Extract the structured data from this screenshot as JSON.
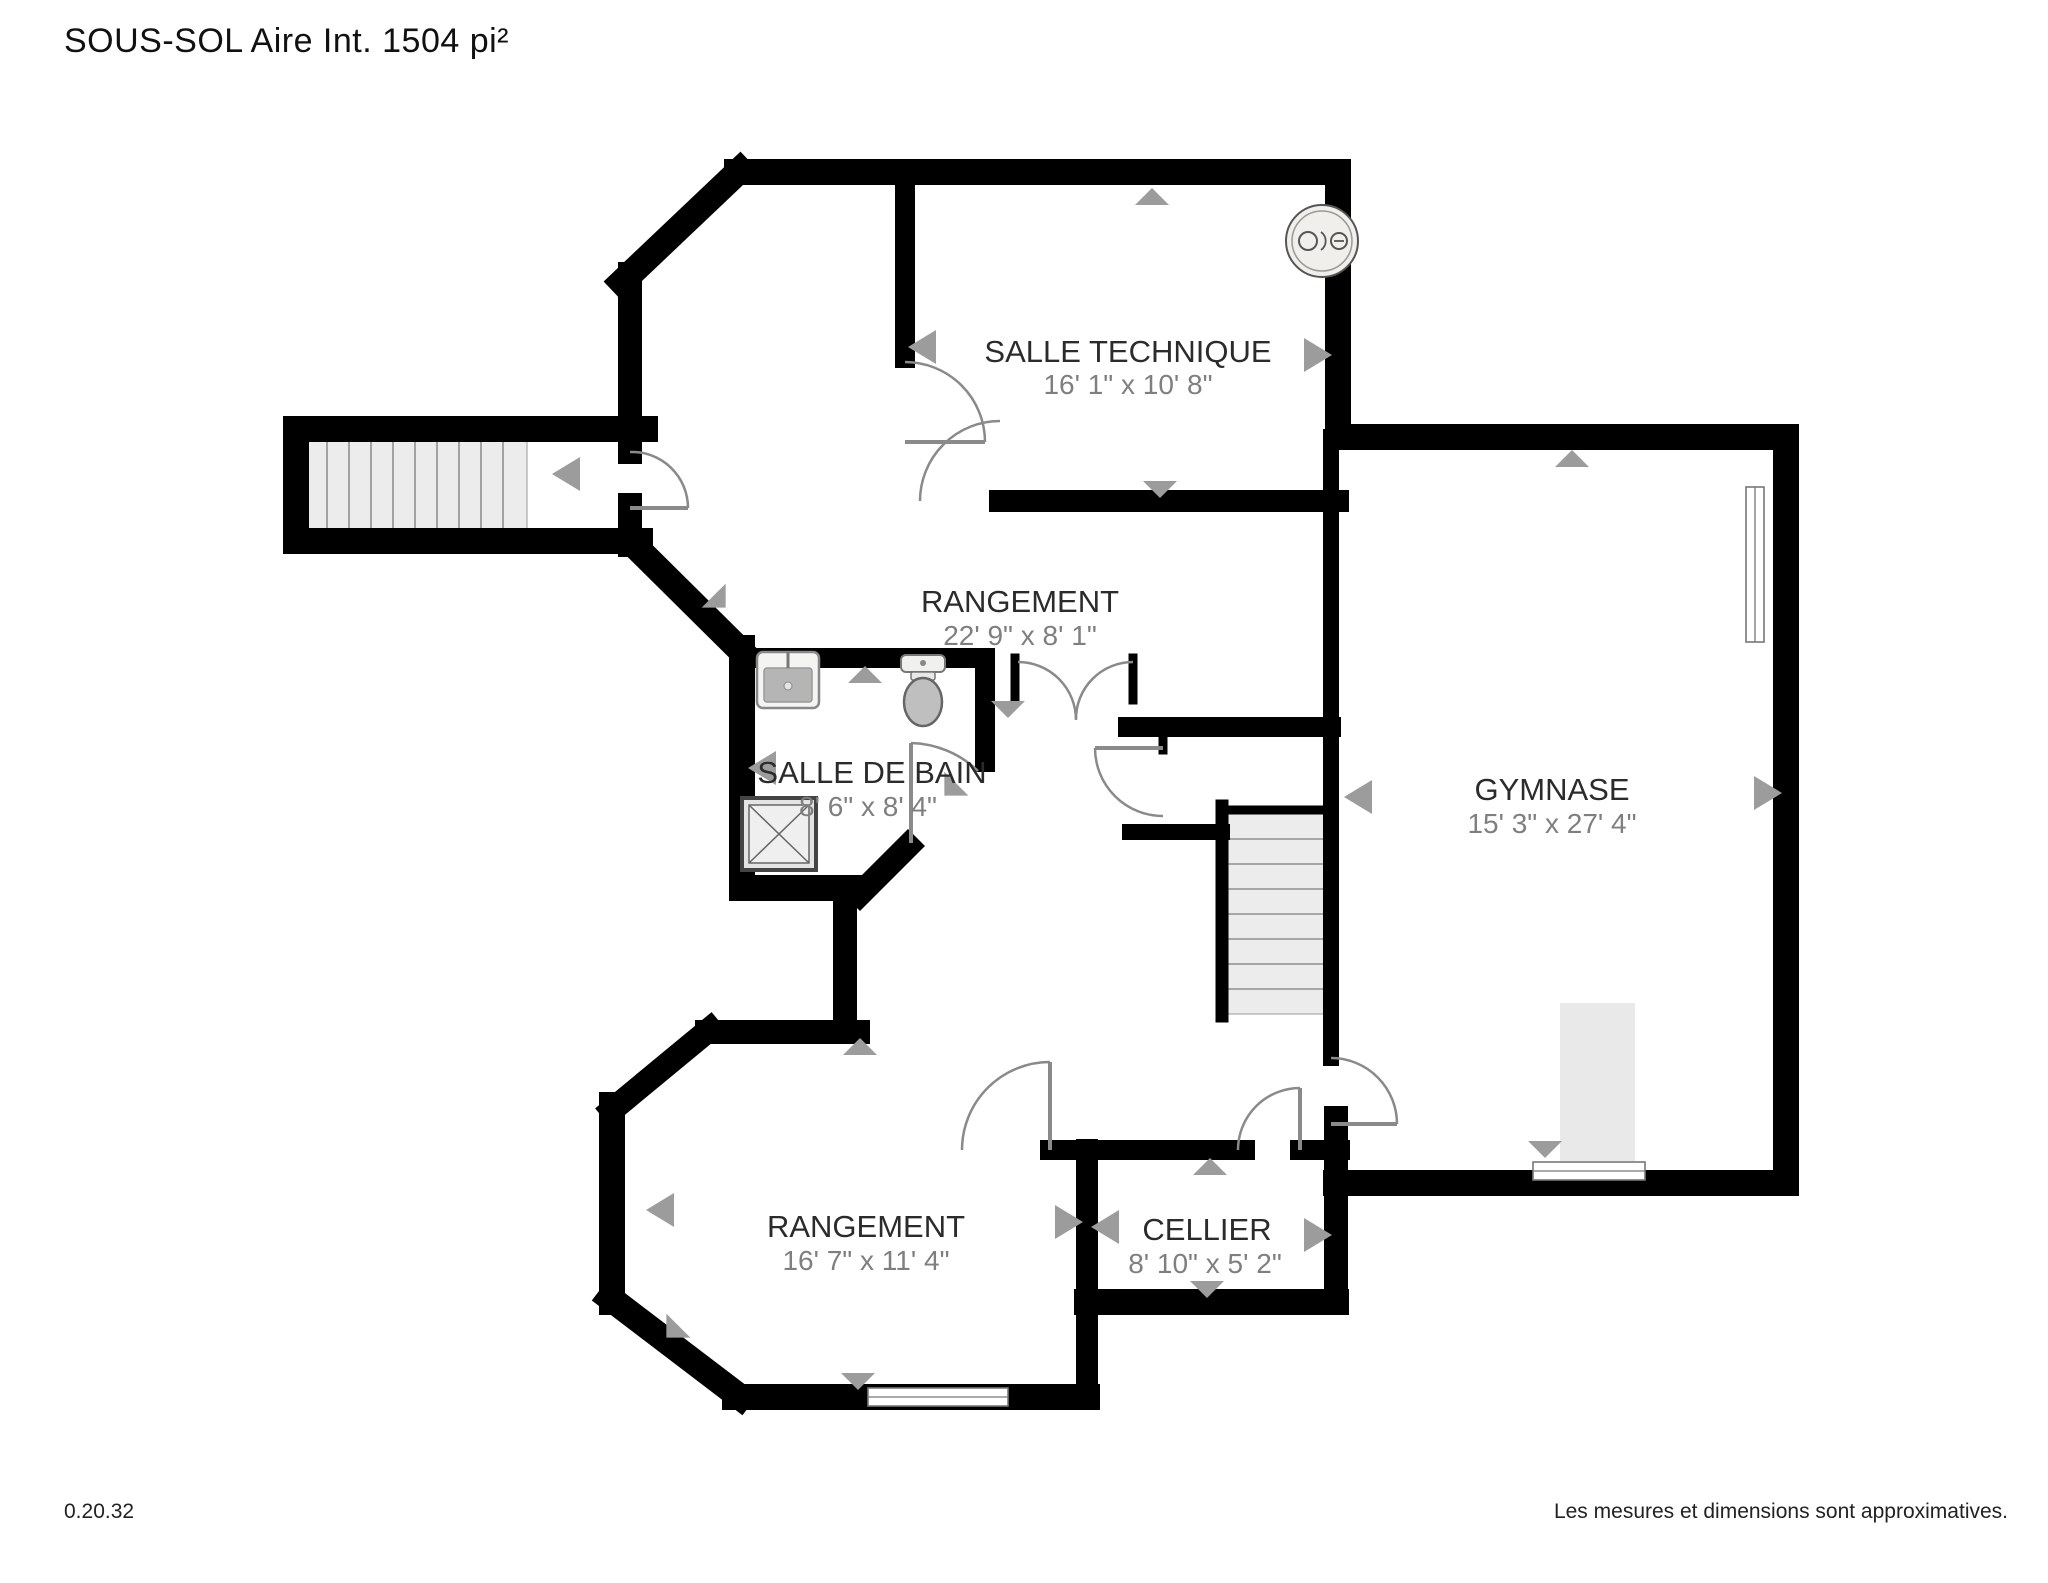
{
  "title": "SOUS-SOL Aire Int. 1504 pi²",
  "version": "0.20.32",
  "disclaimer": "Les mesures et dimensions sont approximatives.",
  "rooms": [
    {
      "id": "salle-technique",
      "name": "SALLE TECHNIQUE",
      "dimensions": "16' 1\" x 10' 8\""
    },
    {
      "id": "rangement-haut",
      "name": "RANGEMENT",
      "dimensions": "22' 9\" x 8' 1\""
    },
    {
      "id": "salle-de-bain",
      "name": "SALLE DE BAIN",
      "dimensions": "8' 6\" x 8' 4\""
    },
    {
      "id": "gymnase",
      "name": "GYMNASE",
      "dimensions": "15' 3\" x 27' 4\""
    },
    {
      "id": "rangement-bas",
      "name": "RANGEMENT",
      "dimensions": "16' 7\" x 11' 4\""
    },
    {
      "id": "cellier",
      "name": "CELLIER",
      "dimensions": "8' 10\" x 5' 2\""
    }
  ],
  "fixtures": {
    "water_heater": "water-heater-icon",
    "sink": "sink-icon",
    "toilet": "toilet-icon",
    "shower": "shower-icon",
    "stairs_left": "stairs",
    "stairs_center": "stairs"
  },
  "colors": {
    "wall": "#000000",
    "room_name": "#2b2b2b",
    "room_dims": "#7f7f7f",
    "stair_fill": "#ececec",
    "marker": "#9c9c9c"
  }
}
